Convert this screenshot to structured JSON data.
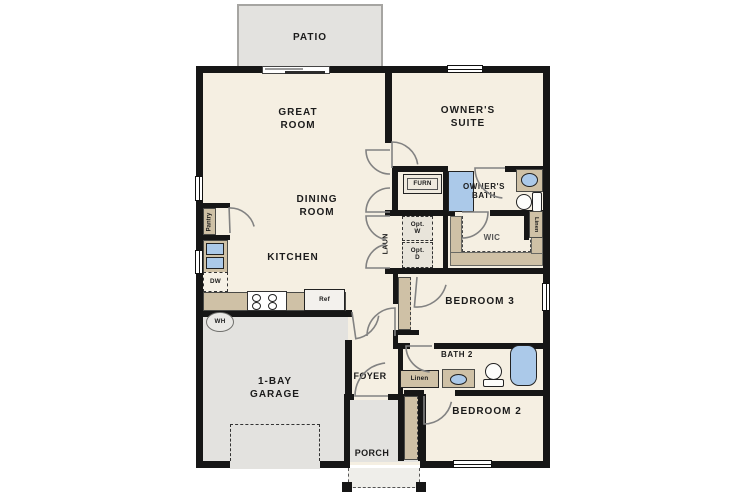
{
  "plan_title": "single-story floor plan",
  "labels": {
    "patio": "PATIO",
    "great_room": "GREAT\nROOM",
    "owners_suite": "OWNER'S\nSUITE",
    "dining_room": "DINING\nROOM",
    "kitchen": "KITCHEN",
    "furnace": "FURN",
    "laundry": "LAUN",
    "opt_washer": "Opt.\nW",
    "opt_dryer": "Opt.\nD",
    "owners_bath": "OWNER'S\nBATH",
    "wic": "WIC",
    "linen_wic": "Linen",
    "pantry": "Pantry",
    "dishwasher": "DW",
    "refrigerator": "Ref",
    "water_heater": "WH",
    "bedroom3": "BEDROOM 3",
    "bath2": "BATH 2",
    "linen_bath2": "Linen",
    "foyer": "FOYER",
    "garage": "1-BAY\nGARAGE",
    "bedroom2": "BEDROOM 2",
    "porch": "PORCH"
  },
  "colors": {
    "floor": "#f5efe2",
    "outdoor_concrete": "#e3e2df",
    "wall": "#161616",
    "cabinetry": "#cfc1a6",
    "plumbing_fixture": "#abc9e9",
    "door_swing": "#828282"
  }
}
